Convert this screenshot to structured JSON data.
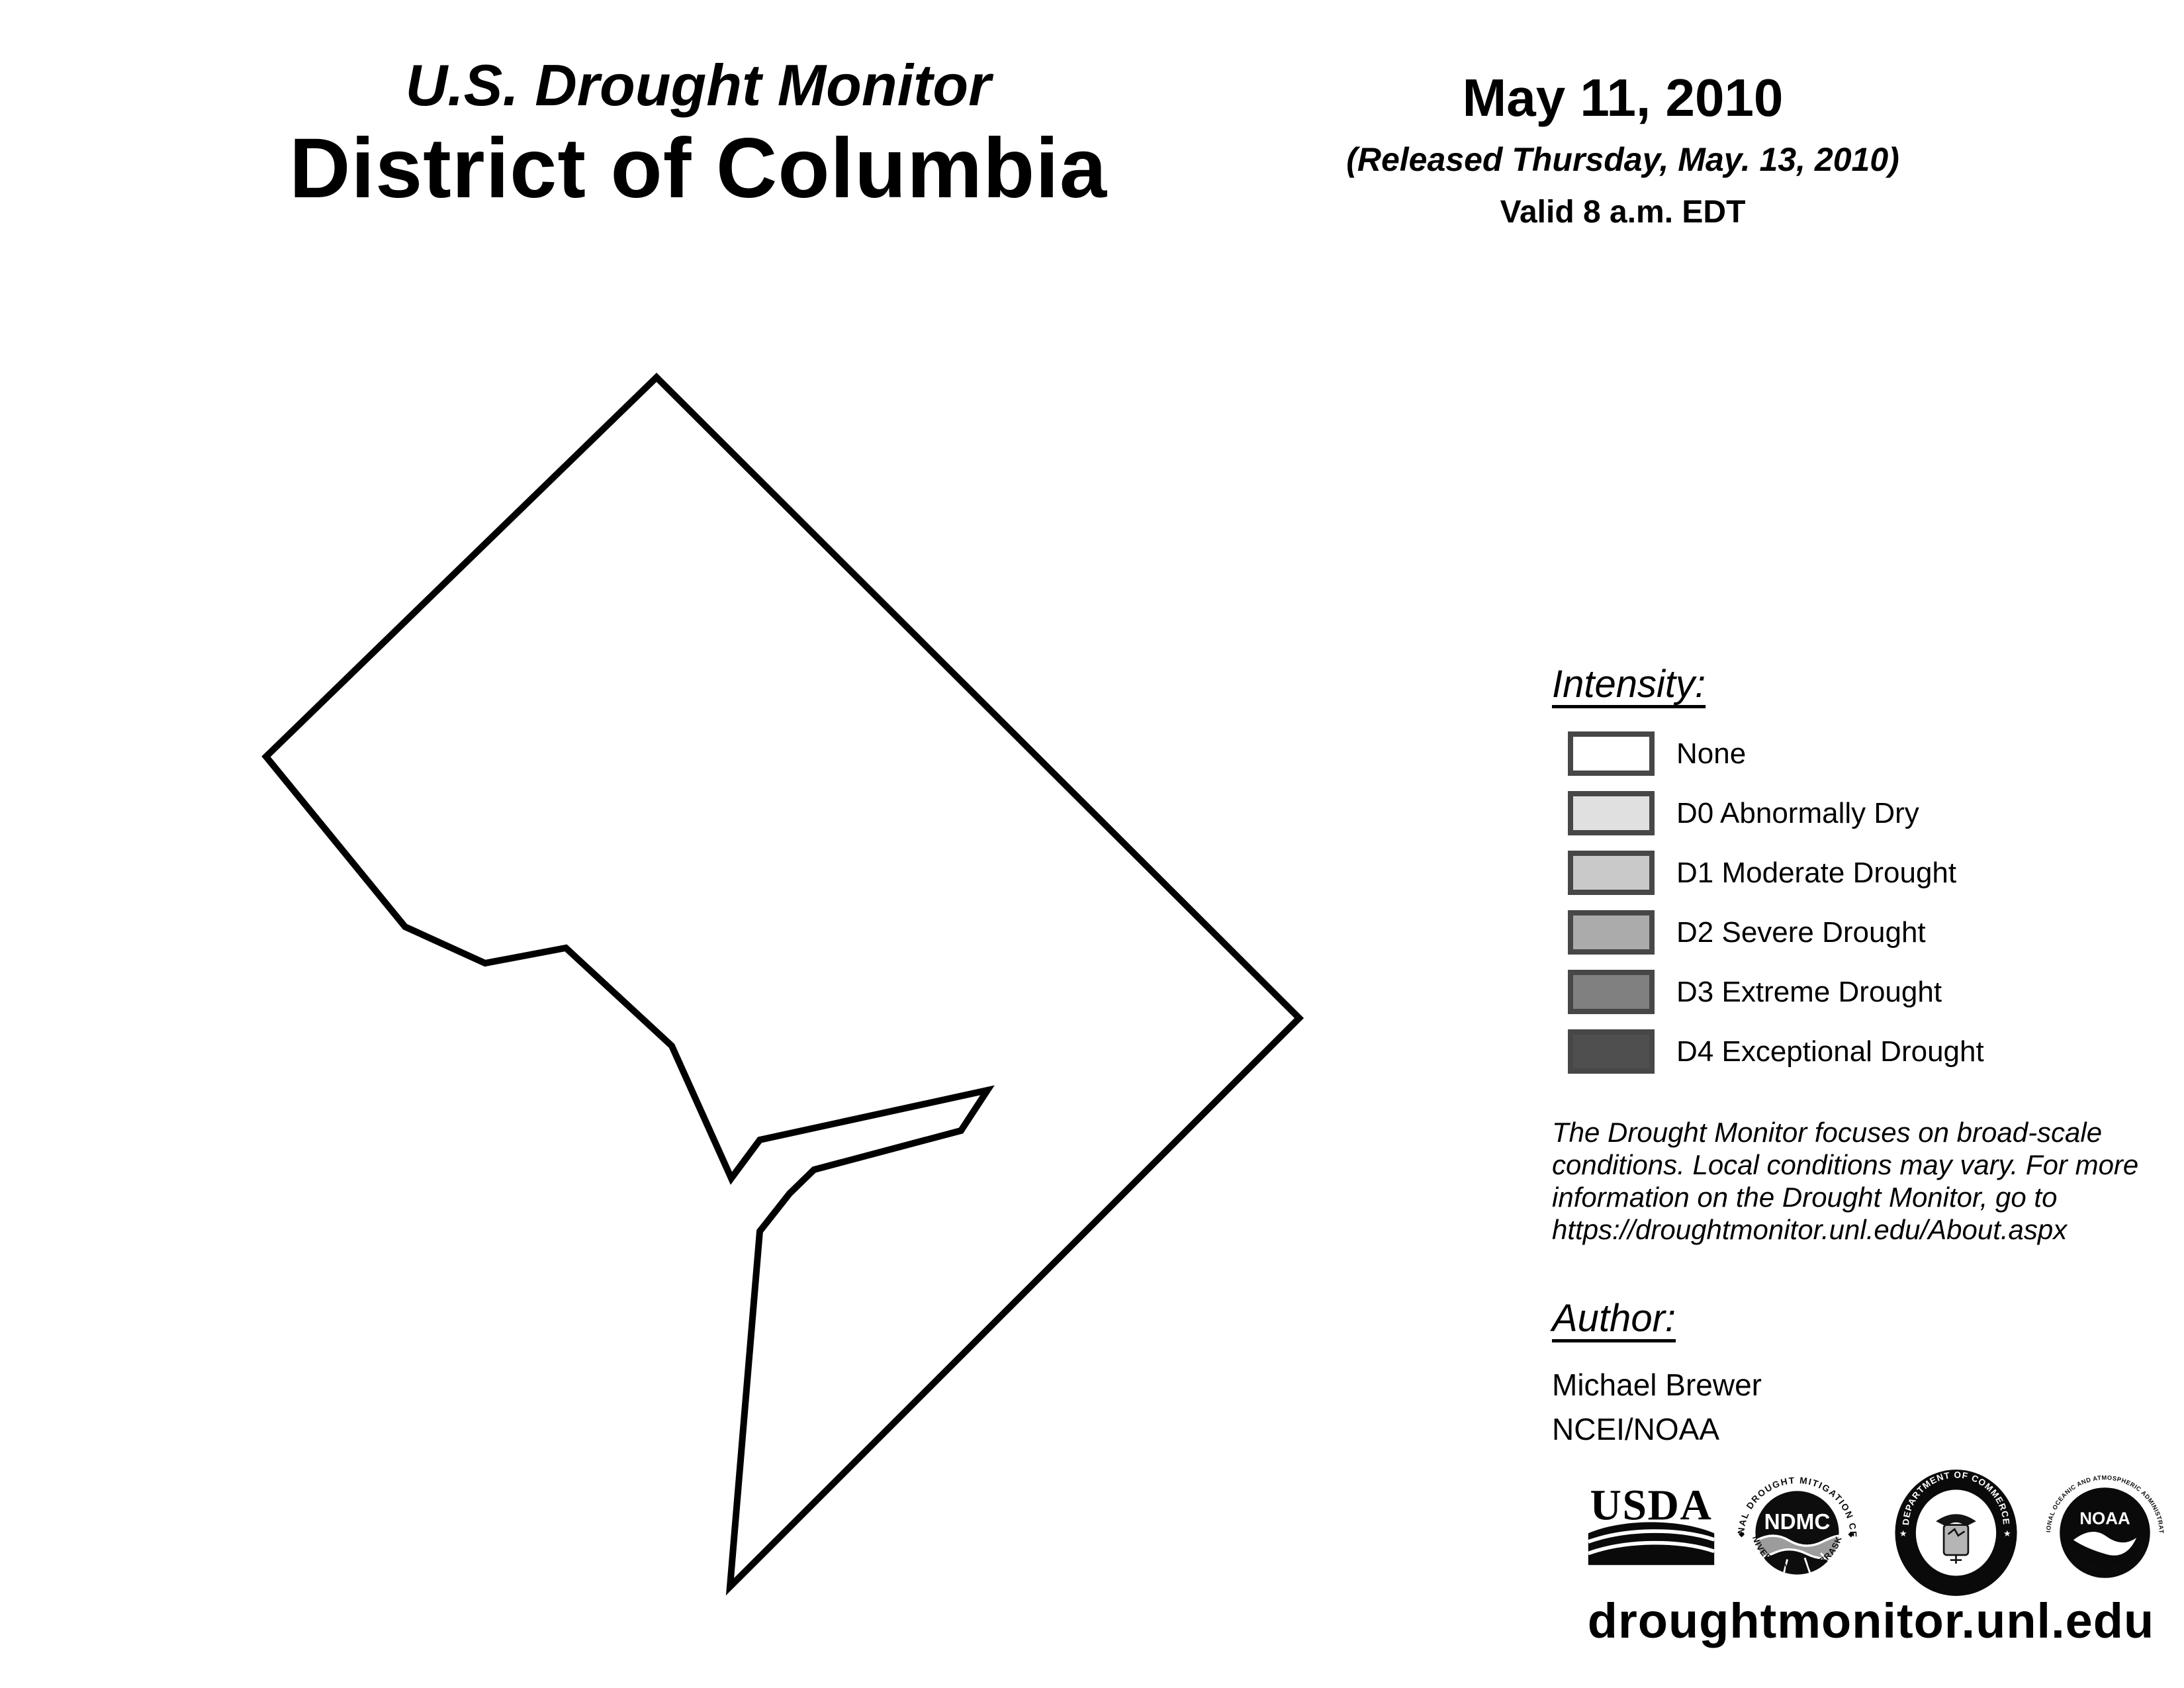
{
  "header": {
    "title_line1": "U.S. Drought Monitor",
    "title_line2": "District of Columbia"
  },
  "date_block": {
    "date": "May 11, 2010",
    "released": "(Released Thursday, May. 13, 2010)",
    "valid": "Valid 8 a.m. EDT"
  },
  "map": {
    "region": "District of Columbia",
    "outline_points": [
      [
        992,
        570
      ],
      [
        1963,
        1538
      ],
      [
        1103,
        2397
      ],
      [
        1148,
        1860
      ],
      [
        1193,
        1803
      ],
      [
        1230,
        1767
      ],
      [
        1452,
        1708
      ],
      [
        1492,
        1647
      ],
      [
        1148,
        1722
      ],
      [
        1105,
        1780
      ],
      [
        1015,
        1580
      ],
      [
        855,
        1432
      ],
      [
        733,
        1455
      ],
      [
        612,
        1400
      ],
      [
        402,
        1143
      ]
    ],
    "stroke_color": "#000000",
    "fill_color": "#ffffff"
  },
  "legend": {
    "heading": "Intensity:",
    "border_color": "#474747",
    "items": [
      {
        "label": "None",
        "color": "#ffffff"
      },
      {
        "label": "D0 Abnormally Dry",
        "color": "#e0e0e0"
      },
      {
        "label": "D1 Moderate Drought",
        "color": "#c9c9c9"
      },
      {
        "label": "D2 Severe Drought",
        "color": "#ababab"
      },
      {
        "label": "D3 Extreme Drought",
        "color": "#808080"
      },
      {
        "label": "D4 Exceptional Drought",
        "color": "#4f4f4f"
      }
    ]
  },
  "disclaimer": {
    "lines": [
      "The Drought Monitor focuses on broad-scale",
      "conditions. Local conditions may vary. For more",
      "information on the Drought Monitor, go to",
      "https://droughtmonitor.unl.edu/About.aspx"
    ]
  },
  "author": {
    "heading": "Author:",
    "name": "Michael Brewer",
    "org": "NCEI/NOAA"
  },
  "logos": {
    "usda": {
      "text": "USDA"
    },
    "ndmc": {
      "abbr": "NDMC",
      "ring_top": "NATIONAL DROUGHT MITIGATION CENTER",
      "ring_bottom": "UNIVERSITY OF NEBRASKA",
      "separator": "◆"
    },
    "doc": {
      "ring_top": "DEPARTMENT OF COMMERCE",
      "ring_bottom": "UNITED STATES OF AMERICA",
      "star": "★"
    },
    "noaa": {
      "abbr": "NOAA",
      "ring_top": "NATIONAL OCEANIC AND ATMOSPHERIC ADMINISTRATION",
      "ring_bottom": "U.S. DEPARTMENT OF COMMERCE"
    }
  },
  "footer": {
    "url": "droughtmonitor.unl.edu"
  }
}
